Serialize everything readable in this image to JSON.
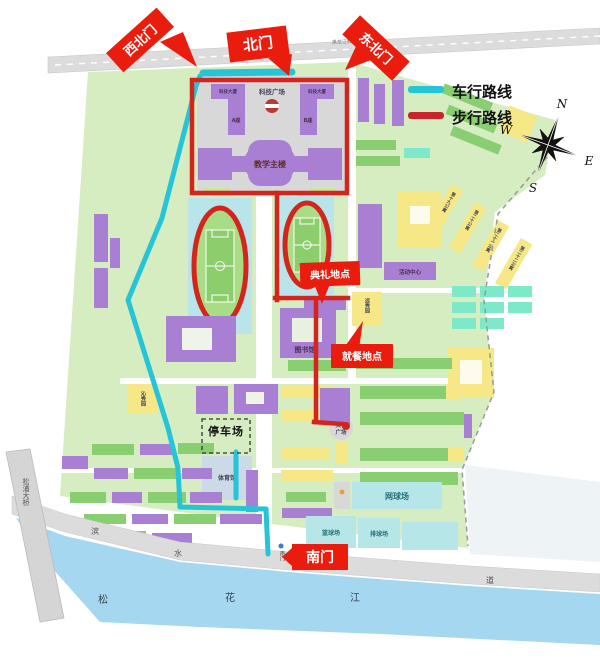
{
  "legend": {
    "vehicle_label": "车行路线",
    "walking_label": "步行路线",
    "vehicle_color": "#25c4d6",
    "walking_color": "#c9252b"
  },
  "compass": {
    "n": "N",
    "e": "E",
    "s": "S",
    "w": "W"
  },
  "gates": {
    "northwest": "西北门",
    "north": "北门",
    "northeast": "东北门",
    "south": "南门",
    "south_road_label": "南门"
  },
  "markers": {
    "ceremony": "典礼地点",
    "dining": "就餐地点",
    "parking": "停车场"
  },
  "campus": {
    "plaza": "科技广场",
    "tower_a_name": "科技大厦",
    "tower_a_unit": "A座",
    "tower_b_name": "科技大厦",
    "tower_b_unit": "B座",
    "main_teaching": "教学主楼",
    "library": "图书馆",
    "gym": "体育馆",
    "activity_center": "活动中心",
    "culture_plaza_line1": "文化",
    "culture_plaza_line2": "广场",
    "tennis": "网球场",
    "basketball": "篮球场",
    "volleyball": "排球场",
    "dining_hall_east": "远秀园",
    "dining_hall_west": "沁秀园",
    "apt_d": "第十九公寓",
    "apt_a": "第二十公寓",
    "apt_b": "第二十一公寓",
    "apt_c": "第二十二公寓"
  },
  "geo": {
    "river_char1": "松",
    "river_char2": "花",
    "river_char3": "江",
    "bridge": "松浦大桥",
    "road_char1": "滨",
    "road_char2": "水",
    "road_char3": "大",
    "road_char4": "道",
    "station": "黑龙江科技大学站",
    "road_char_top": "路"
  },
  "colors": {
    "ground": "#d6edc2",
    "building_purple": "#a87fd2",
    "building_green": "#8ace72",
    "building_yellow": "#f6e886",
    "court_cyan": "#b6e6e8",
    "river_blue": "#a5d8f0",
    "banner_red": "#ea1c0d"
  }
}
